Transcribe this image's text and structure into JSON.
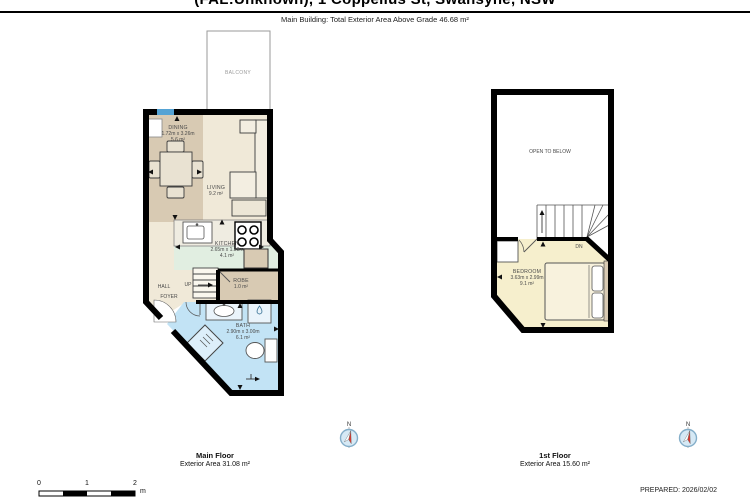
{
  "header": {
    "title": "(FAL:Unknown), 1 Coppelius St, Swansyne, NSW",
    "subtitle": "Main Building: Total Exterior Area Above Grade 46.68 m²"
  },
  "floors": {
    "main": {
      "caption": "Main Floor",
      "caption_area": "Exterior Area 31.08 m²",
      "rooms": {
        "balcony": {
          "name": "BALCONY"
        },
        "dining": {
          "name": "DINING",
          "dims": "1.72m x 3.26m",
          "area": "5.6 m²"
        },
        "living": {
          "name": "LIVING",
          "area": "9.2 m²"
        },
        "kitchen": {
          "name": "KITCHEN",
          "dims": "2.65m x 1.53m",
          "area": "4.1 m²"
        },
        "hall": {
          "name": "HALL"
        },
        "foyer": {
          "name": "FOYER"
        },
        "stairs": {
          "label": "UP"
        },
        "robe": {
          "name": "ROBE",
          "area": "1.0 m²"
        },
        "bath": {
          "name": "BATH",
          "dims": "2.90m x 3.00m",
          "area": "6.1 m²"
        }
      }
    },
    "first": {
      "caption": "1st Floor",
      "caption_area": "Exterior Area 15.60 m²",
      "rooms": {
        "open_to_below": {
          "name": "OPEN TO BELOW"
        },
        "stairs": {
          "label": "DN"
        },
        "bedroom": {
          "name": "BEDROOM",
          "dims": "3.63m x 2.99m",
          "area": "9.1 m²"
        }
      }
    }
  },
  "compass": {
    "north_label": "N"
  },
  "scale_bar": {
    "ticks": [
      "0",
      "1",
      "2"
    ],
    "unit": "m"
  },
  "footer": {
    "prepared": "PREPARED: 2026/02/02"
  },
  "colors": {
    "wall": "#000000",
    "dining_tan": "#d8cab3",
    "living_cream": "#f0e9d8",
    "kitchen_mint": "#e1eee1",
    "bath_blue": "#c2e3f5",
    "bedroom_yellow": "#f6efcd",
    "window_blue": "#55a3d4",
    "compass_red": "#d93a30"
  }
}
